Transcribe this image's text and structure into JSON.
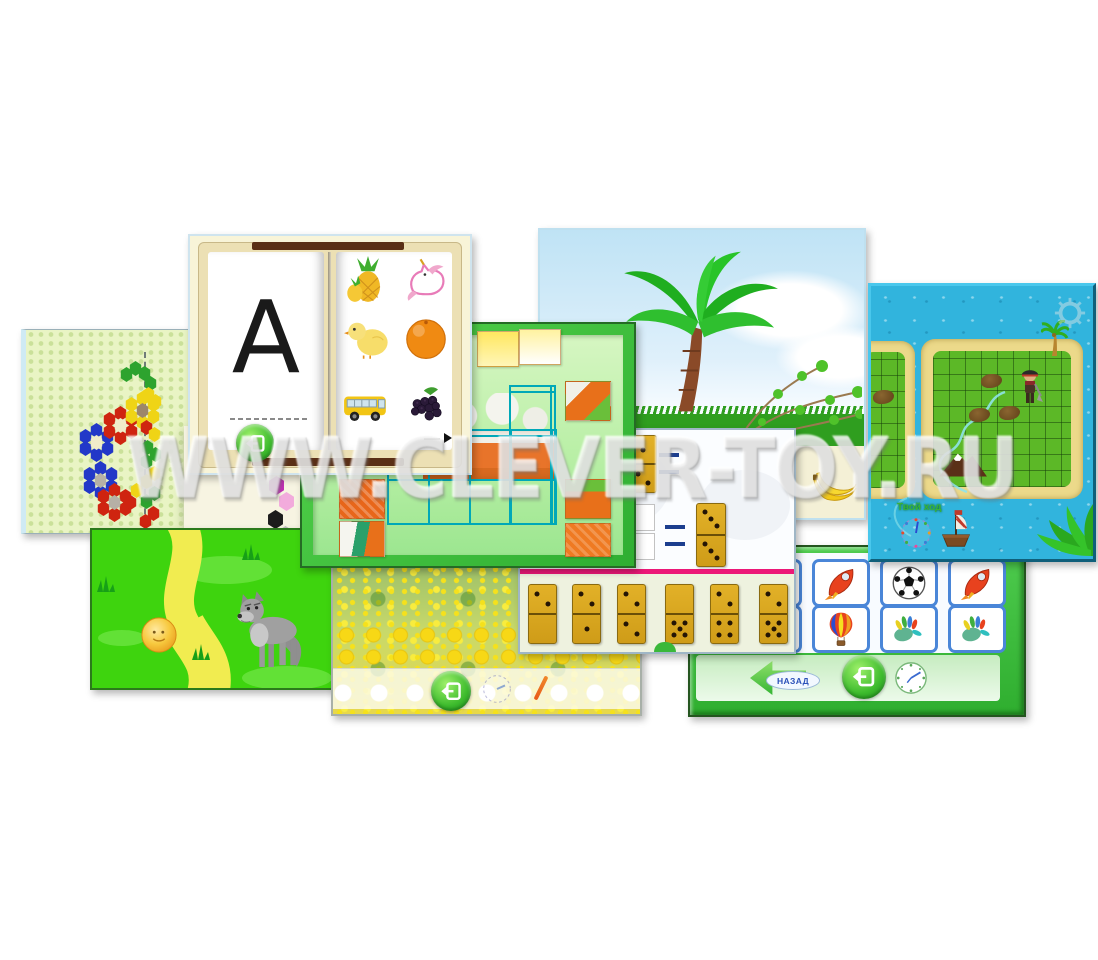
{
  "collage": {
    "watermark": "WWW.CLEVER-TOY.RU",
    "background": "#ffffff"
  },
  "panels": {
    "mosaic": {
      "label": "hex-mosaic-game",
      "board_color": "#e9f4c4",
      "flowers": [
        {
          "cx": 70,
          "cy": 112,
          "ring": "#2238c8",
          "center": "#f1ecca"
        },
        {
          "cx": 94,
          "cy": 95,
          "ring": "#cf2410",
          "center": "#f1ecca"
        },
        {
          "cx": 74,
          "cy": 150,
          "ring": "#2238c8",
          "center": "#b6b0a6"
        },
        {
          "cx": 88,
          "cy": 172,
          "ring": "#cf2410",
          "center": "#b6b0a6"
        },
        {
          "cx": 116,
          "cy": 80,
          "ring": "#efd416",
          "center": "#9c866a"
        }
      ],
      "cells": [
        {
          "x": 100,
          "y": 44,
          "c": "#2da32e"
        },
        {
          "x": 109,
          "y": 38,
          "c": "#2da32e"
        },
        {
          "x": 118,
          "y": 43,
          "c": "#2da32e"
        },
        {
          "x": 124,
          "y": 53,
          "c": "#2da32e"
        },
        {
          "x": 122,
          "y": 64,
          "c": "#efd416"
        },
        {
          "x": 129,
          "y": 71,
          "c": "#efd416"
        },
        {
          "x": 120,
          "y": 97,
          "c": "#cf2410"
        },
        {
          "x": 128,
          "y": 104,
          "c": "#efd416"
        },
        {
          "x": 121,
          "y": 117,
          "c": "#2da32e"
        },
        {
          "x": 129,
          "y": 124,
          "c": "#2da32e"
        },
        {
          "x": 120,
          "y": 131,
          "c": "#2da32e"
        },
        {
          "x": 128,
          "y": 143,
          "c": "#efd416"
        },
        {
          "x": 120,
          "y": 151,
          "c": "#efd416"
        },
        {
          "x": 128,
          "y": 163,
          "c": "#2da32e"
        },
        {
          "x": 120,
          "y": 171,
          "c": "#2da32e"
        },
        {
          "x": 127,
          "y": 183,
          "c": "#cf2410"
        },
        {
          "x": 119,
          "y": 191,
          "c": "#cf2410"
        },
        {
          "x": 110,
          "y": 160,
          "c": "#efd416"
        },
        {
          "x": 104,
          "y": 172,
          "c": "#cf2410"
        }
      ],
      "palette": [
        {
          "shape": "square",
          "color": "#2bd0d6",
          "x": 238,
          "y": 128
        },
        {
          "shape": "hex",
          "color": "#c02cb4",
          "x": 242,
          "y": 146
        },
        {
          "shape": "hex",
          "color": "#f2abdc",
          "x": 252,
          "y": 162
        },
        {
          "shape": "hex",
          "color": "#1c1c1c",
          "x": 241,
          "y": 180
        },
        {
          "shape": "hex",
          "color": "#bdbdbd",
          "x": 251,
          "y": 196
        }
      ]
    },
    "book": {
      "label": "alphabet-book",
      "letter": "А",
      "pictures": [
        "pineapples",
        "unicorn",
        "chick",
        "orange",
        "bus",
        "blackberries"
      ]
    },
    "puzzle": {
      "label": "jigsaw-puzzle-game",
      "grid_color": "#00a8b8"
    },
    "palm": {
      "label": "palm-tree-scene"
    },
    "island": {
      "label": "pirate-island-game",
      "move_label": "Твой ход"
    },
    "domino": {
      "label": "domino-math-game",
      "equations": [
        {
          "left": [
            1,
            2
          ],
          "right": null
        },
        {
          "left": null,
          "right": [
            3,
            3
          ]
        }
      ],
      "tray": [
        [
          2,
          0
        ],
        [
          2,
          1
        ],
        [
          2,
          2
        ],
        [
          0,
          5
        ],
        [
          2,
          4
        ],
        [
          2,
          5
        ]
      ]
    },
    "wolf": {
      "label": "kolobok-story-game"
    },
    "flower": {
      "label": "flower-field-scene"
    },
    "cards": {
      "label": "picture-cards-game",
      "back_label": "НАЗАД",
      "grid": [
        [
          "beach-ball",
          "rocket",
          "soccer-ball",
          "rocket"
        ],
        [
          "soccer-ball",
          "hot-air-balloon",
          "handprint",
          "handprint"
        ]
      ]
    }
  }
}
